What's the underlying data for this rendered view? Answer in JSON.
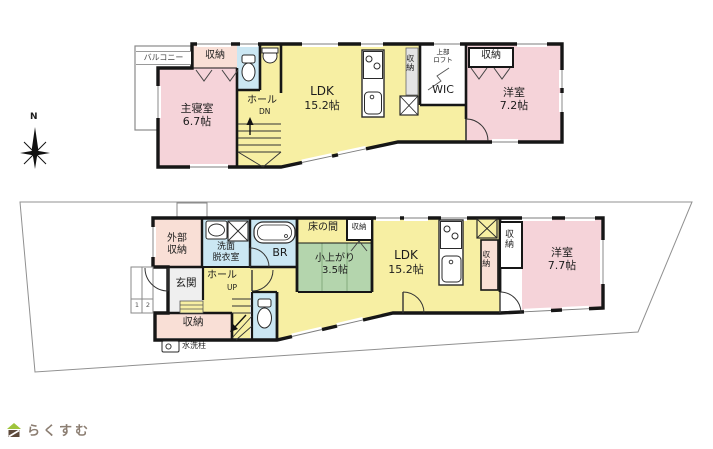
{
  "compass": {
    "north_label": "N"
  },
  "logo": {
    "brand": "らくすむ"
  },
  "colors": {
    "room_pink": "#f5d3d9",
    "storage_peach": "#f9dfd6",
    "ldk_yellow": "#f7efa3",
    "tatami_green": "#b4d5ad",
    "wet_blue": "#cbe7f3",
    "closet_gray": "#e4e4e4",
    "genkan_gray": "#efefef",
    "wall": "#161616",
    "lot_line": "#909090"
  },
  "floor2": {
    "balcony": "バルコニー",
    "storage_left": "収納",
    "master_bedroom_name": "主寝室",
    "master_bedroom_size": "6.7帖",
    "hall": "ホール",
    "stairs_dn": "DN",
    "ldk_name": "LDK",
    "ldk_size": "15.2帖",
    "kitchen_storage": "収納",
    "loft_line1": "上部",
    "loft_line2": "ロフト",
    "wic": "WIC",
    "storage_right": "収納",
    "western_name": "洋室",
    "western_size": "7.2帖"
  },
  "floor1": {
    "ext_storage_line1": "外部",
    "ext_storage_line2": "収納",
    "washroom_line1": "洗面",
    "washroom_line2": "脱衣室",
    "bath": "BR",
    "tokonoma": "床の間",
    "storage_top": "収納",
    "koagari_name": "小上がり",
    "koagari_size": "3.5帖",
    "ldk_name": "LDK",
    "ldk_size": "15.2帖",
    "storage_mid_a": "収納",
    "storage_mid_b": "収納",
    "western_name": "洋室",
    "western_size": "7.7帖",
    "genkan": "玄関",
    "hall": "ホール",
    "stairs_up": "UP",
    "storage_bottom": "収納",
    "water_post": "水洗柱",
    "step_1": "1",
    "step_2": "2"
  }
}
